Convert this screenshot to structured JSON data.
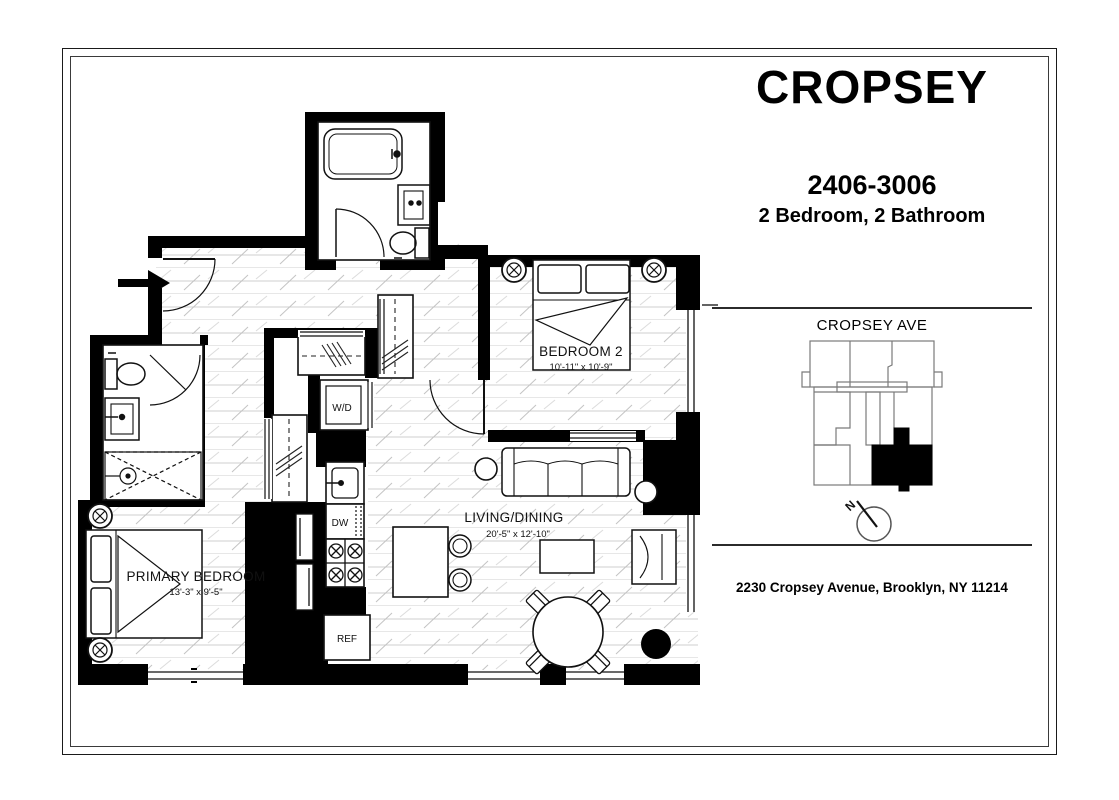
{
  "header": {
    "building_name": "CROPSEY",
    "unit_number": "2406-3006",
    "unit_type": "2 Bedroom, 2 Bathroom"
  },
  "key_plan": {
    "street_label": "CROPSEY AVE",
    "compass_label": "N",
    "highlight_color": "#000000"
  },
  "footer": {
    "address": "2230 Cropsey Avenue, Brooklyn, NY 11214"
  },
  "floor_plan": {
    "rooms": [
      {
        "id": "bedroom2",
        "label": "BEDROOM 2",
        "dimensions": "10'-11\" x 10'-9\""
      },
      {
        "id": "primary_bedroom",
        "label": "PRIMARY BEDROOM",
        "dimensions": "13'-3\" x 9'-5\""
      },
      {
        "id": "living_dining",
        "label": "LIVING/DINING",
        "dimensions": "20'-5\" x 12'-10\""
      }
    ],
    "appliances": [
      {
        "id": "washer_dryer",
        "label": "W/D"
      },
      {
        "id": "dishwasher",
        "label": "DW"
      },
      {
        "id": "refrigerator",
        "label": "REF"
      }
    ]
  }
}
